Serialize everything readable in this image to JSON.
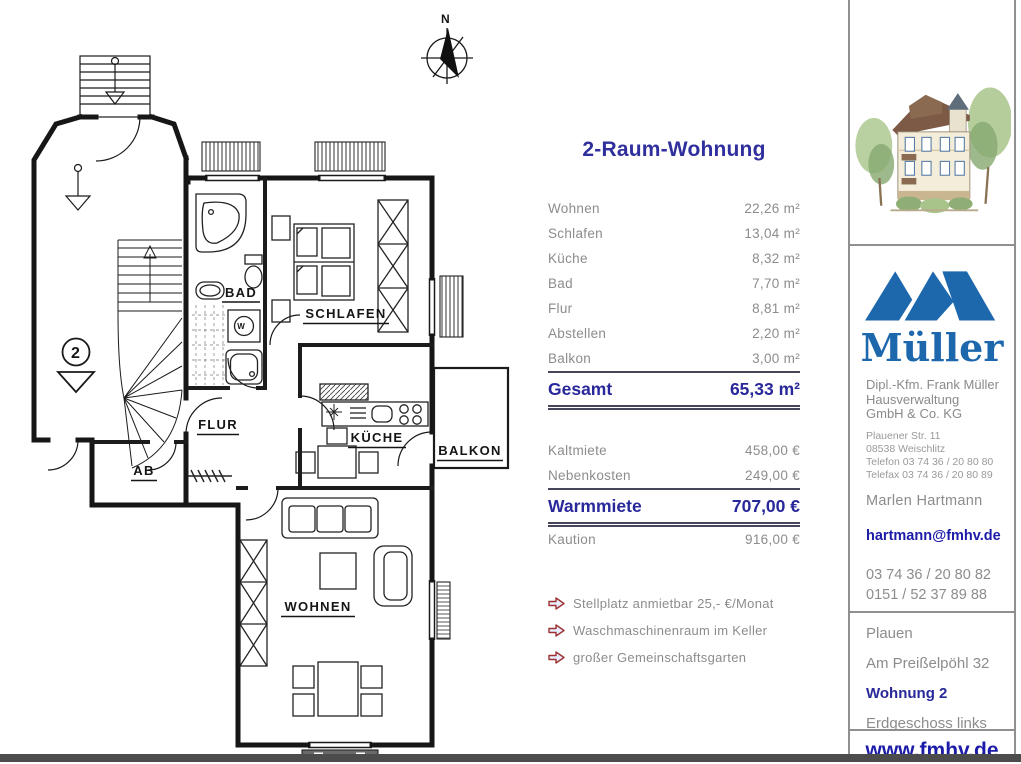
{
  "title": "2-Raum-Wohnung",
  "areas": {
    "rows": [
      {
        "label": "Wohnen",
        "value": "22,26 m²"
      },
      {
        "label": "Schlafen",
        "value": "13,04 m²"
      },
      {
        "label": "Küche",
        "value": "8,32 m²"
      },
      {
        "label": "Bad",
        "value": "7,70 m²"
      },
      {
        "label": "Flur",
        "value": "8,81 m²"
      },
      {
        "label": "Abstellen",
        "value": "2,20 m²"
      },
      {
        "label": "Balkon",
        "value": "3,00 m²"
      }
    ],
    "total_label": "Gesamt",
    "total_value": "65,33 m²"
  },
  "costs": {
    "rows": [
      {
        "label": "Kaltmiete",
        "value": "458,00 €"
      },
      {
        "label": "Nebenkosten",
        "value": "249,00 €"
      }
    ],
    "warm_label": "Warmmiete",
    "warm_value": "707,00 €",
    "deposit_label": "Kaution",
    "deposit_value": "916,00 €"
  },
  "features": [
    "Stellplatz anmietbar 25,- €/Monat",
    "Waschmaschinenraum im Keller",
    "großer Gemeinschaftsgarten"
  ],
  "floor_plan": {
    "labels": {
      "bad": "BAD",
      "schlafen": "SCHLAFEN",
      "flur": "FLUR",
      "ab": "AB",
      "kueche": "KÜCHE",
      "balkon": "BALKON",
      "wohnen": "WOHNEN",
      "compass_n": "N",
      "floor_number": "2",
      "washer": "W"
    }
  },
  "sidebar": {
    "logo_text": "Müller",
    "company": [
      "Dipl.-Kfm. Frank Müller",
      "Hausverwaltung",
      "GmbH & Co. KG"
    ],
    "company_small": [
      "Plauener Str. 11",
      "08538 Weischlitz",
      "Telefon 03 74 36 / 20 80 80",
      "Telefax 03 74 36 / 20 80 89"
    ],
    "contact_name": "Marlen Hartmann",
    "contact_email": "hartmann@fmhv.de",
    "contact_phones": [
      "03 74 36 / 20 80 82",
      "0151 / 52 37 89 88"
    ],
    "address": {
      "city": "Plauen",
      "street": "Am Preißelpöhl 32",
      "unit": "Wohnung 2",
      "floor": "Erdgeschoss links"
    },
    "website": "www.fmhv.de"
  },
  "colors": {
    "navy": "#28289a",
    "title_navy": "#2f2f9d",
    "link_navy": "#1c1ca8",
    "logo_blue": "#1d67ad",
    "text_gray": "#8c8c8c",
    "divider_gray": "#909090",
    "bottom_bar": "#4c4c4c",
    "arrow_outline": "#9c3333",
    "arrow_fill": "#e8edff"
  }
}
